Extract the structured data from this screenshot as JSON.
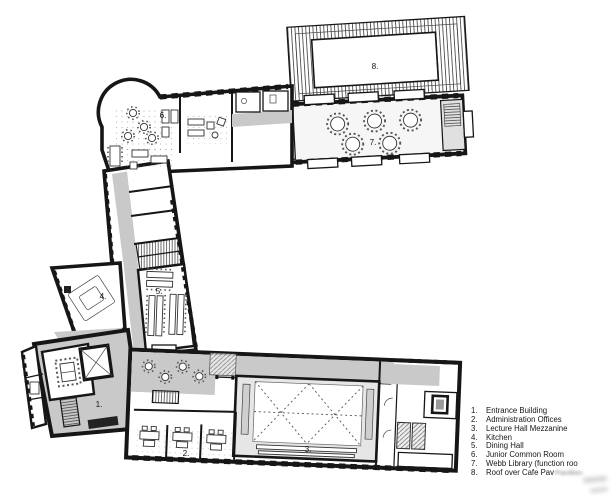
{
  "plan": {
    "room_labels": [
      {
        "num": "1.",
        "x": 99,
        "y": 407
      },
      {
        "num": "2.",
        "x": 186,
        "y": 456
      },
      {
        "num": "3.",
        "x": 308,
        "y": 452
      },
      {
        "num": "4.",
        "x": 103,
        "y": 299
      },
      {
        "num": "5.",
        "x": 159,
        "y": 294
      },
      {
        "num": "6.",
        "x": 163,
        "y": 118
      },
      {
        "num": "7.",
        "x": 373,
        "y": 145
      },
      {
        "num": "8.",
        "x": 375,
        "y": 69
      }
    ]
  },
  "legend": {
    "items": [
      {
        "num": "1.",
        "label": "Entrance Building"
      },
      {
        "num": "2.",
        "label": "Administration Offices"
      },
      {
        "num": "3.",
        "label": "Lecture Hall Mezzanine"
      },
      {
        "num": "4.",
        "label": "Kitchen"
      },
      {
        "num": "5.",
        "label": "Dining Hall"
      },
      {
        "num": "6.",
        "label": "Junior Common Room"
      },
      {
        "num": "7.",
        "label": "Webb Library (function roo"
      },
      {
        "num": "8.",
        "label": "Roof over Cafe Pav",
        "smudge": "Pavilion"
      }
    ]
  },
  "colors": {
    "ink": "#161616",
    "corridor": "#c9c9c9",
    "hall-wash": "#e6e6e6",
    "stair-fill": "#e0e0e0",
    "paper": "#ffffff"
  }
}
